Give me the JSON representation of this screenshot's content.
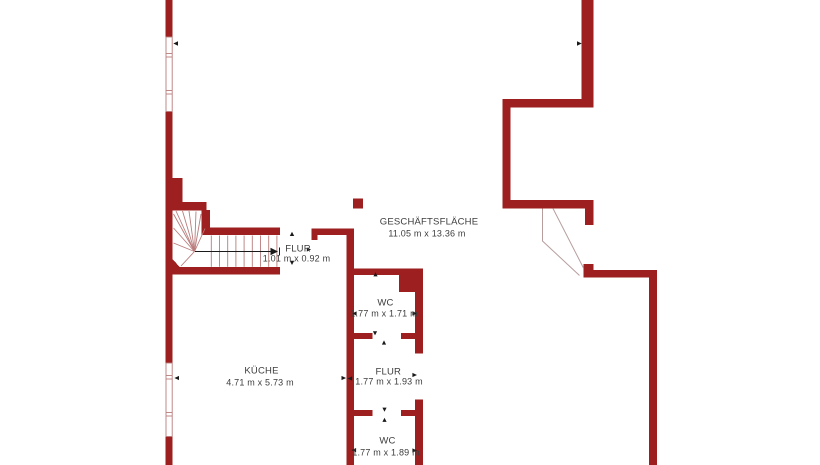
{
  "plan": {
    "type": "floor-plan",
    "colors": {
      "wall": "#9e1f1f",
      "thin_line": "#b97c7c",
      "door_line": "#b79e9e",
      "arrow": "#1a1a1a",
      "text": "#3d3d3d",
      "background": "#ffffff"
    },
    "rooms": [
      {
        "id": "geschaeftsflaeche",
        "name": "GESCHÄFTSFLÄCHE",
        "dimensions": "11.05 m x 13.36 m"
      },
      {
        "id": "flur-1",
        "name": "FLUR",
        "dimensions": "1.01 m x 0.92 m"
      },
      {
        "id": "wc-1",
        "name": "WC",
        "dimensions": "1.77 m x 1.71 m"
      },
      {
        "id": "kueche",
        "name": "KÜCHE",
        "dimensions": "4.71 m x 5.73 m"
      },
      {
        "id": "flur-2",
        "name": "FLUR",
        "dimensions": "1.77 m x 1.93 m"
      },
      {
        "id": "wc-2",
        "name": "WC",
        "dimensions": "1.77 m x 1.89 m"
      }
    ]
  }
}
